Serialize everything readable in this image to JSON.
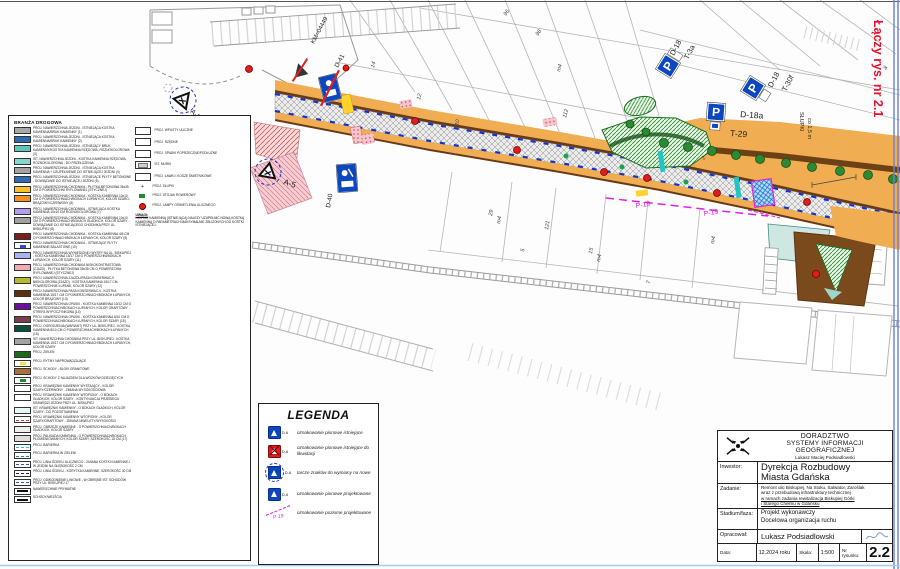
{
  "connector_note": "Łączy rys. nr 2.1",
  "road_legend": {
    "title": "BRANŻA DROGOWA",
    "items": [
      {
        "sw": {
          "type": "solid",
          "bg": "#a8a8a8"
        },
        "label": "PROJ. NAWIERZCHNIA JEZDNI - ISTNIEJĄCA KOSTKA KAMIENNA/BRUK KAMIENNY (1)"
      },
      {
        "sw": {
          "type": "solid",
          "bg": "#2e6db4"
        },
        "label": "PROJ. NAWIERZCHNIA JEZDNI - ISTNIEJĄCA KOSTKA KAMIENNA/BRUK KAMIENNY (2)"
      },
      {
        "sw": {
          "type": "solid",
          "bg": "#5ec7b8"
        },
        "label": "PROJ. NAWIERZCHNIA JEZDNI - ISTNIEJĄCY BRUK KAMIENNY/KOSTKA KAMIENNA RZĘDOWA, RÓŻNOKOLOROWA (3)"
      },
      {
        "sw": {
          "type": "solid",
          "bg": "#83d8cb"
        },
        "label": "IST. NAWIERZCHNIA JEZDNI - KOSTKA KAMIENNA RZĘDOWA, RÓŻNOKOLOROWA - DO PRZEŁOŻENIA"
      },
      {
        "sw": {
          "type": "solid",
          "bg": "#a3a3a3"
        },
        "label": "PROJ. NAWIERZCHNIA JEZDNI - ISTNIEJĄCA KOSTKA KAMIENNA + UZUPEŁNIENIE DO ISTNIEJĄCEJ JEZDNI (4)"
      },
      {
        "sw": {
          "type": "solid",
          "bg": "#2e6db4"
        },
        "label": "PROJ. NAWIERZCHNIA JEZDNI - ISTNIEJĄCE PŁYTY BETONOWE - DOWIĄZANIE DO ISTNIEJĄCEJ JEZDNI (5)"
      },
      {
        "sw": {
          "type": "solid",
          "bg": "#ffc125"
        },
        "label": "PROJ. NAWIERZCHNIA CHODNIKA - PŁYTKA BETONOWA 35x35 CM O POWIERZCHNI RYFLOWANEJ (STYCZNEJ)"
      },
      {
        "sw": {
          "type": "solid",
          "bg": "#f78f1e"
        },
        "label": "PROJ. NAWIERZCHNIA CHODNIKA - KOSTKA KAMIENNA 10x10 CM O POWIERZCHNIACH/BOKACH ŁUPANYCH, KOLOR SZARO-BRĄZOWY/CZERWONY (6)"
      },
      {
        "sw": {
          "type": "solid",
          "bg": "#b39df2"
        },
        "label": "PROJ. NAWIERZCHNIA CHODNIKA - ISTNIEJĄCA KOSTKA KAMIENNA 10x10 CM RÓŻNOKOLOROWA (7)"
      },
      {
        "sw": {
          "type": "solid",
          "bg": "#a0a0a0"
        },
        "label": "PROJ. NAWIERZCHNIA CHODNIKA - KOSTKA KAMIENNA 10x10 CM O POWIERZCHNIACH/BOKACH GŁADKICH, KOLOR SZARY - DOWIĄZANIE DO ISTNIEJĄCEGO CHODNIKA PRZY UL. BISKUPIEJ (8)"
      },
      {
        "sw": {
          "type": "solid",
          "bg": "#7d1d1d"
        },
        "label": "PROJ. NAWIERZCHNIA CHODNIKA - KOSTKA KAMIENNA 4/6 CM O POWIERZCHNIACH/BOKACH ŁUPANYCH, KOLOR SZARY (9)"
      },
      {
        "sw": {
          "type": "inner",
          "bg": "#ffffff",
          "line": "#2e4fd4"
        },
        "label": "PROJ. NAWIERZCHNIA CHODNIKA - ISTNIEJĄCE PŁYTY KAMIENNE BALASTOWE (10)"
      },
      {
        "sw": {
          "type": "solid",
          "bg": "#a9b5ee"
        },
        "label": "PROJ. NAWIERZCHNIA WYNIESIONEJ WYSPY NA UL. BISKUPIEJ - KOSTKA KAMIENNA 15/17 CM O POWIERZCHNI/BOKACH ŁUPANYCH, KOLOR SZARY (11)"
      },
      {
        "sw": {
          "type": "solid",
          "bg": "#f3a9b4"
        },
        "label": "PROJ. NAWIERZCHNIA CHODNIKA NISKOKONTRASTOWA (ZJAZD) - PŁYTKA BETONOWA 35x35 CM O POWIERZCHNI RYFLOWANEJ (STYCZNEJ)"
      },
      {
        "sw": {
          "type": "solid",
          "bg": "#b9b92f"
        },
        "label": "PROJ. NAWIERZCHNIA ZJAZDU/PASA KONSERWACJI NIEKOLOROWA (ZJAZD) - KOSTKA KAMIENNA 15/17 CM, POWIERZCHNIE ŁUPANE, KOLOR SZARY (12)"
      },
      {
        "sw": {
          "type": "solid",
          "bg": "#5b2f10"
        },
        "label": "PROJ. NAWIERZCHNIA PASA KONSERWACJI - KOSTKA KAMIENNA 15/17 CM O POWIERZCHNIACH/BOKACH ŁUPANYCH, KOLOR BRĄZOWY (13)"
      },
      {
        "sw": {
          "type": "solid",
          "bg": "#6a0f9e"
        },
        "label": "PROJ. NAWIERZCHNIA OPASKI - KOSTKA KAMIENNA 10/12 CM O POWIERZCHNIACH/BOKACH ŁUPANYCH, KOLOR GRAFITOWY - STREFA WYPOCZYNKOWA (14)"
      },
      {
        "sw": {
          "type": "solid",
          "bg": "#7c3f4e"
        },
        "label": "PROJ. NAWIERZCHNIA OPASKI - KOSTKA KAMIENNA 8/10 CM O POWIERZCHNIACH/BOKACH ŁUPANYCH, KOLOR SZARY (15)"
      },
      {
        "sw": {
          "type": "solid",
          "bg": "#0c4f3c"
        },
        "label": "PROJ. OGRODZENIA (WARIANT) PRZY UL. BISKUPIEJ - KOSTKA KAMIENNA 8/10 CM O POWIERZCHNIACH/BOKACH ŁUPANYCH (16)"
      },
      {
        "sw": {
          "type": "solid",
          "bg": "#a2a2a2"
        },
        "label": "IST. NAWIERZCHNIA CHODNIKA PRZY UL. BISKUPIEJ - KOSTKA KAMIENNA 15/17 CM O POWIERZCHNIACH/BOKACH ŁUPANYCH, KOLOR SZARY"
      },
      {
        "sw": {
          "type": "solid",
          "bg": "#1c6b1c"
        },
        "label": "PROJ. ZIELEŃ"
      },
      {
        "sw": {
          "type": "inner",
          "bg": "#ffffff",
          "line": "#f2e23a"
        },
        "label": "PROJ. RYTMY NAPROWADZAJĄCE"
      },
      {
        "sw": {
          "type": "solid",
          "bg": "#a9703f"
        },
        "label": "PROJ. SCHODY - BLOKI GRANITOWE"
      },
      {
        "sw": {
          "type": "inner",
          "bg": "#ffffff",
          "line": "#1f8a2e"
        },
        "label": "PROJ. SCHODY Z NAJAZDEM DLA WÓZKÓW DZIECIĘCYCH"
      },
      {
        "sw": {
          "type": "outline",
          "bg": "#ffffff"
        },
        "label": "PROJ. KRAWĘŻNIK KAMIENNY WYSTAJĄCY - KOLOR SZARY/CZERWONY - ZMIANA WYSOKOŚCIOWA"
      },
      {
        "sw": {
          "type": "outline",
          "bg": "#ffffff"
        },
        "label": "PROJ. KRAWĘŻNIK KAMIENNY WTOPIONY - O BOKACH GŁADKICH, KOLOR SZARY - KONTYNUACJA PRZEBIEGU KRAWĘDZI JEZDNI PRZY UL. BISKUPIEJ"
      },
      {
        "sw": {
          "type": "outline",
          "bg": "#e8f7f5"
        },
        "label": "IST. KRAWĘŻNIK KAMIENNY - O BOKACH GŁADKICH, KOLOR SZARY - DO POZOSTAWIENIA"
      },
      {
        "sw": {
          "type": "dash",
          "bg": "#ffffff",
          "line": "#c23a3a",
          "dash": "dashed"
        },
        "label": "PROJ. KRAWĘŻNIK KAMIENNY WTOPIONY - KOLOR SZARY/GRAFITOWY - ZMIANA NIWELETY/WYSOKOŚCI"
      },
      {
        "sw": {
          "type": "outline",
          "bg": "#efefef"
        },
        "label": "PROJ. OBRZEŻE KAMIENNE - O POWIERZCHNIACH/BOKACH GŁADKICH, KOLOR SZARY"
      },
      {
        "sw": {
          "type": "outline",
          "bg": "#dedede"
        },
        "label": "PROJ. PALISADA KAMIENNA - O POWIERZCHNIACH/BOKACH PŁOMIENIOWANYCH, KOLOR SZARY, SZEROKOŚĆ 15 CM (17)"
      },
      {
        "sw": {
          "type": "dash",
          "bg": "#ffffff",
          "line": "#22c4c4",
          "dash": "dashed"
        },
        "label": "PROJ. BARIERKA"
      },
      {
        "sw": {
          "type": "dash",
          "bg": "#ffffff",
          "line": "#1f8a7e",
          "dash": "dashed"
        },
        "label": "PROJ. BARIERKA W ZIELENI"
      },
      {
        "sw": {
          "type": "dash",
          "bg": "#ffffff",
          "line": "#2e4fd4",
          "dash": "dashed"
        },
        "label": "PROJ. LINIA ŚCIEKU ULICZNEGO - ZMIANA KOSTKI KAMIENNEJ W JEZDNI NA GŁĘBOKOŚĆ 2 CM"
      },
      {
        "sw": {
          "type": "dash",
          "bg": "#ffffff",
          "line": "#10206e",
          "dash": "dashed"
        },
        "label": "PROJ. LINIA ŚCIEKU - KORYTKA KAMIENNE, SZEROKOŚĆ 30 CM"
      },
      {
        "sw": {
          "type": "dash",
          "bg": "#ffffff",
          "line": "#2e4fd4",
          "dash": "dashed"
        },
        "label": "PROJ. ODWODNIENIE LINIOWE - W OBRĘBIE IST. SCHODÓW PRZY UL. BISKUPIEJ 17"
      },
      {
        "sw": {
          "type": "plaque",
          "bg": "#ffffff",
          "line": "#10206e"
        },
        "label": "NAWIERZCHNIE PRYWATNE"
      },
      {
        "sw": {
          "type": "plaque",
          "bg": "#ffffff",
          "line": "#0c4f3c"
        },
        "label": "SCHODY/WEJŚCIA"
      }
    ],
    "side_items": [
      {
        "icon": "box",
        "label": "PROJ. WPUSTY ULICZNE"
      },
      {
        "icon": "box",
        "label": "PROJ. RZĘDNE"
      },
      {
        "icon": "box",
        "label": "PROJ. SPADKI POPRZECZNE/PODŁUŻNE"
      },
      {
        "icon": "boxin",
        "label": "IST. MURKI"
      },
      {
        "icon": "box",
        "label": "PROJ. ŁAWKI I KOSZE ŚMIETNIKOWE"
      },
      {
        "icon": "plus",
        "label": "PROJ. SŁUPKI"
      },
      {
        "icon": "bike",
        "label": "PROJ. STOJAK ROWEROWY"
      },
      {
        "icon": "lamp",
        "label": "PROJ. LAMPY OŚWIETLENIA ULICZNEGO"
      }
    ],
    "note_title": "UWAGI:",
    "note": "KOSTKĘ KAMIENNĄ (ISTNIEJĄCĄ) NALEŻY UZUPEŁNIĆ NOWĄ KOSTKĄ KAMIENNĄ O PARAMETRACH MAKSYMALNIE ZBLIŻONYCH DO KOSTKI ISTNIEJĄCEJ."
  },
  "legend_box": {
    "title": "LEGENDA",
    "items": [
      {
        "icon": "sign",
        "code": "D-6",
        "label": "oznakowanie pionowe istniejące"
      },
      {
        "icon": "sign-x",
        "code": "D-6",
        "label": "oznakowanie pionowe istniejące do likwidacji"
      },
      {
        "icon": "sign-circ",
        "code": "D-6",
        "label": "tarcze znaków do wymiany na nowe"
      },
      {
        "icon": "sign",
        "code": "D-6",
        "label": "oznakowanie pionowe projektowane"
      },
      {
        "icon": "p19",
        "code": "P-19",
        "label": "oznakowanie poziome projektowane"
      }
    ]
  },
  "title_block": {
    "company1": "DORADZTWO",
    "company2": "SYSTEMY INFORMACJI GEOGRAFICZNEJ",
    "company3": "Lukasz Maciej Podsiadlowski",
    "investor_label": "Inwestor:",
    "investor1": "Dyrekcja Rozbudowy",
    "investor2": "Miasta Gdańska",
    "task_label": "Zadanie:",
    "task_lines": [
      "Remont ulic Biskupiej, Na Stoku, Salwator, Zaroślak",
      "wraz z przebudową infrastruktury technicznej",
      "w ramach zadania rewitalizacja Biskupiej Górki",
      "i Starego Chełmu w Gdańsku"
    ],
    "stage_label": "Stadium/faza:",
    "stage1": "Projekt wykonawczy",
    "stage2": "Docelowa organizacja ruchu",
    "author_label": "Opracował:",
    "author": "Lukasz Podsiadlowski",
    "date_label": "Data:",
    "date": "12.2024 roku",
    "scale_label": "Skala:",
    "scale": "1:500",
    "number_label": "Nr rysunku:",
    "number": "2.2"
  },
  "map": {
    "accent_colors": {
      "sign_blue": "#0d47c0",
      "marking_magenta": "#e020e0",
      "note_red": "#e8112d"
    },
    "p_signs": [
      {
        "x": 668,
        "y": 66,
        "rot": -58,
        "letter": "P",
        "plate": "side"
      },
      {
        "x": 753,
        "y": 88,
        "rot": -58,
        "letter": "P",
        "plate": "below"
      },
      {
        "x": 716,
        "y": 112,
        "rot": 4,
        "letter": "P",
        "plate": "wheel"
      }
    ],
    "labels": [
      {
        "t": "Łączy rys. nr 2.1",
        "x": 874,
        "y": 20,
        "rot": 90,
        "size": 12.5,
        "color": "#e8112d",
        "bold": true,
        "name": "connector-note"
      },
      {
        "t": "D-18",
        "x": 674,
        "y": 56,
        "rot": -62,
        "size": 7.5
      },
      {
        "t": "T-3a",
        "x": 688,
        "y": 60,
        "rot": -62,
        "size": 7.5
      },
      {
        "t": "D-18",
        "x": 772,
        "y": 88,
        "rot": -62,
        "size": 7.5
      },
      {
        "t": "T-30f",
        "x": 786,
        "y": 92,
        "rot": -62,
        "size": 7.5
      },
      {
        "t": "D-18a",
        "x": 740,
        "y": 117,
        "rot": 4,
        "size": 8.5
      },
      {
        "t": "T-29",
        "x": 730,
        "y": 136,
        "rot": 4,
        "size": 8.5
      },
      {
        "t": "KM=04449",
        "x": 314,
        "y": 44,
        "rot": -62,
        "size": 6
      },
      {
        "t": "D-41",
        "x": 338,
        "y": 68,
        "rot": -62,
        "size": 6.5
      },
      {
        "t": "D-40",
        "x": 330,
        "y": 208,
        "rot": -80,
        "size": 6.5
      },
      {
        "t": "A-5",
        "x": 190,
        "y": 112,
        "rot": 45,
        "size": 7
      },
      {
        "t": "A-5",
        "x": 283,
        "y": 184,
        "rot": 18,
        "size": 8
      },
      {
        "t": "SŁUPKI",
        "x": 800,
        "y": 112,
        "rot": 90,
        "size": 5.5
      },
      {
        "t": "co 1,5 m",
        "x": 808,
        "y": 118,
        "rot": 90,
        "size": 5.5
      },
      {
        "t": "P-19",
        "x": 636,
        "y": 208,
        "rot": -9,
        "size": 7,
        "color": "#e020e0"
      },
      {
        "t": "P-19",
        "x": 704,
        "y": 216,
        "rot": -9,
        "size": 7,
        "color": "#e020e0"
      }
    ],
    "parcel_numbers": [
      {
        "t": "14",
        "x": 374,
        "y": 68,
        "rot": -75
      },
      {
        "t": "12",
        "x": 420,
        "y": 100,
        "rot": -75
      },
      {
        "t": "10",
        "x": 458,
        "y": 126,
        "rot": -75
      },
      {
        "t": "96",
        "x": 506,
        "y": 16,
        "rot": -55
      },
      {
        "t": "98",
        "x": 538,
        "y": 36,
        "rot": -55
      },
      {
        "t": "m4",
        "x": 560,
        "y": 72,
        "rot": -75
      },
      {
        "t": "112",
        "x": 566,
        "y": 118,
        "rot": -75
      },
      {
        "t": "29",
        "x": 492,
        "y": 216,
        "rot": -80
      },
      {
        "t": "m4",
        "x": 500,
        "y": 224,
        "rot": -80
      },
      {
        "t": "5",
        "x": 524,
        "y": 252,
        "rot": -80
      },
      {
        "t": "121",
        "x": 548,
        "y": 230,
        "rot": -80
      },
      {
        "t": "15",
        "x": 592,
        "y": 254,
        "rot": -80
      },
      {
        "t": "m4",
        "x": 600,
        "y": 262,
        "rot": -80
      },
      {
        "t": "7",
        "x": 650,
        "y": 284,
        "rot": -80
      },
      {
        "t": "2",
        "x": 704,
        "y": 160,
        "rot": -55
      },
      {
        "t": "m4",
        "x": 714,
        "y": 244,
        "rot": -80
      },
      {
        "t": "8",
        "x": 886,
        "y": 70,
        "rot": -55
      }
    ]
  }
}
